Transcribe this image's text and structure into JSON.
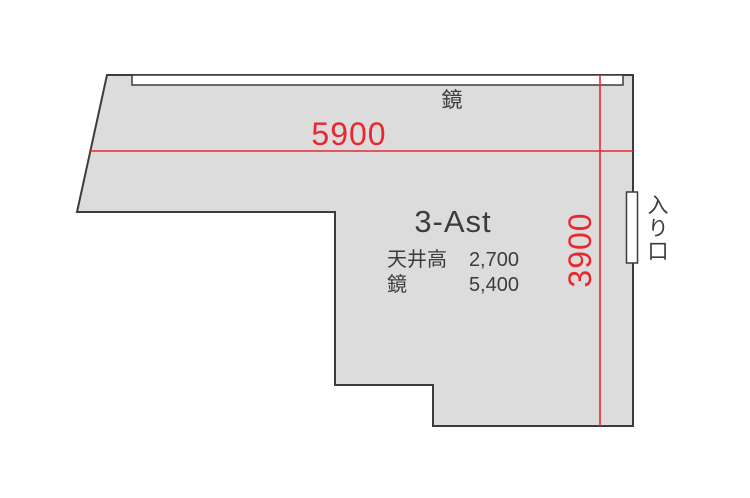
{
  "floorplan": {
    "room_name": "3-Ast",
    "mirror_label": "鏡",
    "entrance_label": "入り口",
    "dimensions": {
      "width": "5900",
      "height": "3900"
    },
    "specs": [
      {
        "label": "天井高",
        "value": "2,700"
      },
      {
        "label": "鏡",
        "value": "5,400"
      }
    ],
    "colors": {
      "room_fill": "#dcdcdd",
      "outline": "#3f3b3a",
      "dimension_red": "#e8282e",
      "fixture_fill": "#ffffff"
    }
  }
}
